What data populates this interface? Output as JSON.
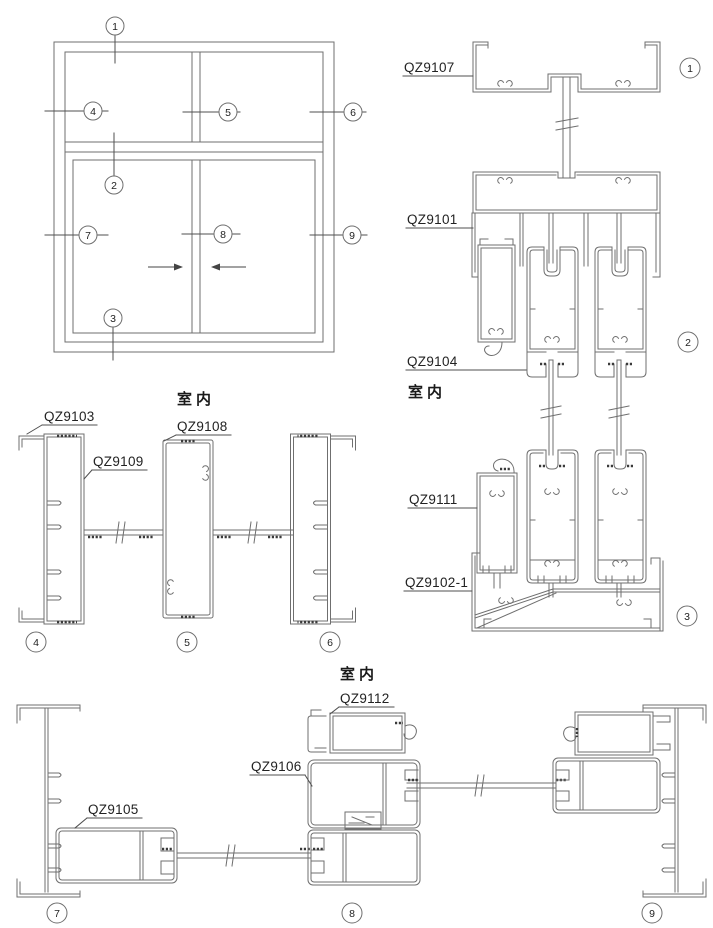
{
  "interior": {
    "label": "室内"
  },
  "labels": {
    "qz9107": "QZ9107",
    "qz9101": "QZ9101",
    "qz9104": "QZ9104",
    "qz9111": "QZ9111",
    "qz9102_1": "QZ9102-1",
    "qz9103": "QZ9103",
    "qz9109": "QZ9109",
    "qz9108": "QZ9108",
    "qz9105": "QZ9105",
    "qz9106": "QZ9106",
    "qz9112": "QZ9112"
  },
  "markers": {
    "m1": "1",
    "m2": "2",
    "m3": "3",
    "m4": "4",
    "m5": "5",
    "m6": "6",
    "m7": "7",
    "m8": "8",
    "m9": "9"
  },
  "colors": {
    "line": "#6f6f6f",
    "leader": "#4f4f4f",
    "text": "#222222",
    "gasket": "#3a3a3a",
    "background": "#ffffff"
  }
}
